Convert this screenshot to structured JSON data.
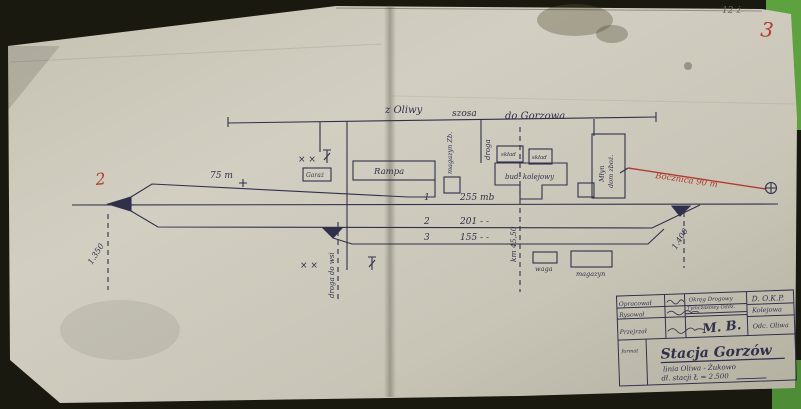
{
  "photo": {
    "background": "#191910",
    "paper": "#ccc8ba",
    "backing_green": "#5ea13f",
    "ink": "#30304c",
    "red": "#b23a2e"
  },
  "header_road": {
    "from_label": "z Oliwy",
    "road_label": "szosa",
    "to_label": "do Gorzowa"
  },
  "tracks": {
    "siding_length": "75 m",
    "rows": [
      {
        "no": "1",
        "length": "255 mb"
      },
      {
        "no": "2",
        "length": "201 - -"
      },
      {
        "no": "3",
        "length": "155 - -"
      }
    ],
    "bocznica_label": "Bocznica 90 m",
    "km_left": "1.350",
    "km_right": "1.400",
    "km_crossing": "km 45,50",
    "road_vertical": "droga",
    "road_lower": "droga do wsi"
  },
  "buildings": {
    "rampa": "Rampa",
    "garaz": "Garaż",
    "magazyn_zb": "magazyn Zb.",
    "sklad_1": "skład",
    "sklad_2": "skład",
    "bud_kolejowy": "bud. kolejowy",
    "mlyn_line1": "Młyn",
    "mlyn_line2": "dom zboż.",
    "waga": "waga",
    "magazyn": "magazyn"
  },
  "symbols": {
    "level_crossing": "× ×"
  },
  "red_marks": {
    "left": "2",
    "corner": "3",
    "pencil": "12 ż"
  },
  "title_block": {
    "row_labels": [
      "Opracował",
      "Rysował",
      "Przejrzał"
    ],
    "office_line1": "Okręg Drogowy",
    "office_line2": "Tymczasowy Oddz.",
    "signature": "M. B.",
    "org_line1": "D. O.K.P.",
    "org_line2": "Kolejowa",
    "org_line3": "Odc. Oliwa",
    "format_label": "format",
    "station_title": "Stacja Gorzów",
    "line_label": "linia Oliwa - Żukowo",
    "length_label": "dł. stacji Ł = 2.500"
  }
}
